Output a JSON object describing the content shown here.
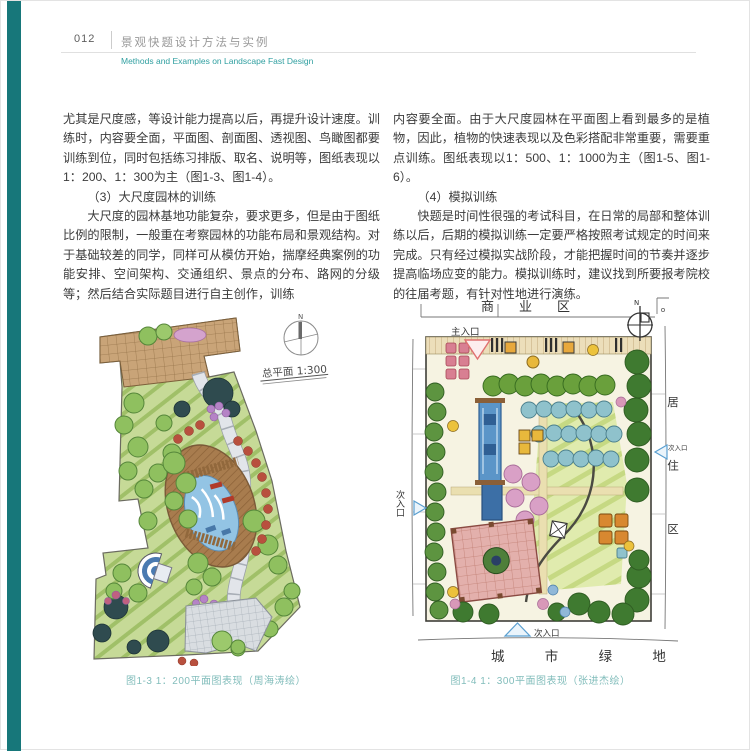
{
  "page": {
    "number": "012",
    "title_zh": "景观快题设计方法与实例",
    "title_en": "Methods and Examples on Landscape Fast Design"
  },
  "columns": {
    "left": {
      "p1": "尤其是尺度感，等设计能力提高以后，再提升设计速度。训练时，内容要全面，平面图、剖面图、透视图、鸟瞰图都要训练到位，同时包括练习排版、取名、说明等，图纸表现以1：200、1：300为主（图1-3、图1-4）。",
      "h1": "（3）大尺度园林的训练",
      "p2": "大尺度的园林基地功能复杂，要求更多，但是由于图纸比例的限制，一般重在考察园林的功能布局和景观结构。对于基础较差的同学，同样可从模仿开始，揣摩经典案例的功能安排、空间架构、交通组织、景点的分布、路网的分级等；然后结合实际题目进行自主创作，训练"
    },
    "right": {
      "p1": "内容要全面。由于大尺度园林在平面图上看到最多的是植物，因此，植物的快速表现以及色彩搭配非常重要，需要重点训练。图纸表现以1：500、1：1000为主（图1-5、图1-6）。",
      "h1": "（4）模拟训练",
      "p2": "快题是时间性很强的考试科目，在日常的局部和整体训练以后，后期的模拟训练一定要严格按照考试规定的时间来完成。只有经过模拟实战阶段，才能把握时间的节奏并逐步提高临场应变的能力。模拟训练时，建议找到所要报考院校的往届考题，有针对性地进行演练。"
    }
  },
  "figures": {
    "fig3": {
      "caption": "图1-3 1：200平面图表现（周海涛绘）",
      "plan_title": "总平面 1:300",
      "north_label": "N"
    },
    "fig4": {
      "caption": "图1-4 1：300平面图表现（张进杰绘）",
      "north_label": "N",
      "labels": {
        "top_zone": "商　业　区",
        "main_entrance": "主入口",
        "side_entrance_left": "次入口",
        "side_entrance_right": "次入口",
        "side_entrance_bottom": "次入口",
        "residential": "居住区",
        "bottom_zone": "城 市 绿 地"
      }
    }
  },
  "colors": {
    "accent_teal": "#17777a",
    "header_teal": "#2f9fa0",
    "caption_teal": "#82bdbb"
  }
}
